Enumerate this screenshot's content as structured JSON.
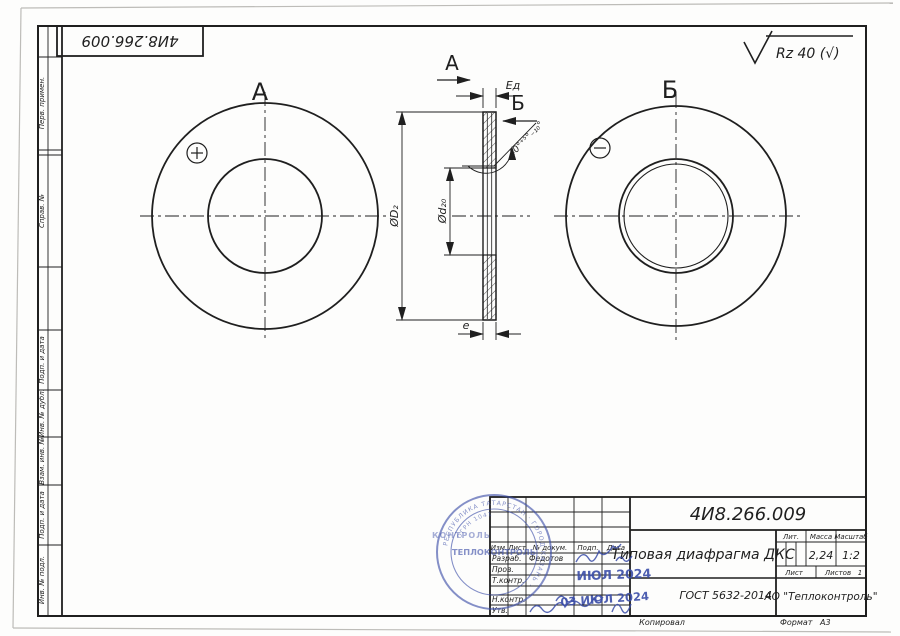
{
  "page": {
    "ink": "#1f1f1f",
    "blue": "#3b4da8",
    "paper": "#fdfdfc"
  },
  "top_stamp": {
    "text": "4И8.266.009"
  },
  "roughness": {
    "text": "Rz 40 (√)"
  },
  "views": {
    "view_a": {
      "label": "А",
      "marker": "+"
    },
    "view_b": {
      "label": "Б",
      "marker": "−"
    },
    "section": {
      "arrow_a": "А",
      "arrow_b": "Б",
      "dim_thickness": "Ед",
      "dim_outer": "ØD₂",
      "dim_bore": "Ød₂₀",
      "dim_edge": "e",
      "angle": "40°⁺⁵°₋₁₀°"
    }
  },
  "margin_labels": {
    "top": [
      "Перв. примен.",
      "Справ. №"
    ],
    "bottom": [
      "Подп. и дата",
      "Инв. № дубл.",
      "Взам. инв. №",
      "Подп. и дата",
      "Инв. № подл."
    ]
  },
  "title_block": {
    "designation": "4И8.266.009",
    "title": "Типовая диафрагма ДКС",
    "standard": "ГОСТ 5632-2014",
    "company": "АО \"Теплоконтроль\"",
    "headers": {
      "izm": "Изм.",
      "list": "Лист",
      "doc": "№ докум.",
      "sign": "Подп.",
      "date": "Дата",
      "lit": "Лит.",
      "mass": "Масса",
      "scale": "Масштаб",
      "sheet": "Лист",
      "sheets": "Листов"
    },
    "values": {
      "mass": "2,24",
      "scale": "1:2",
      "sheets_count": "1"
    },
    "rows": [
      {
        "role": "Разраб.",
        "name": "Федотов"
      },
      {
        "role": "Пров.",
        "name": ""
      },
      {
        "role": "Т.контр.",
        "name": ""
      },
      {
        "role": "Н.контр.",
        "name": ""
      },
      {
        "role": "Утв.",
        "name": ""
      }
    ],
    "footer": {
      "copied": "Копировал",
      "format_label": "Формат",
      "format_value": "А3"
    }
  },
  "stamps": {
    "date1": "ИЮЛ 2024",
    "date2": "03 ИЮЛ 2024",
    "seal_center": "ТЕПЛОКОНТРОЛЬ",
    "seal_ring": "РЕСПУБЛИКА ТАТАРСТАН · ГОРОД КАЗАНЬ ·",
    "seal_ring2": "ОГРН 1041",
    "side_text": "КОНТРОЛЬ"
  }
}
